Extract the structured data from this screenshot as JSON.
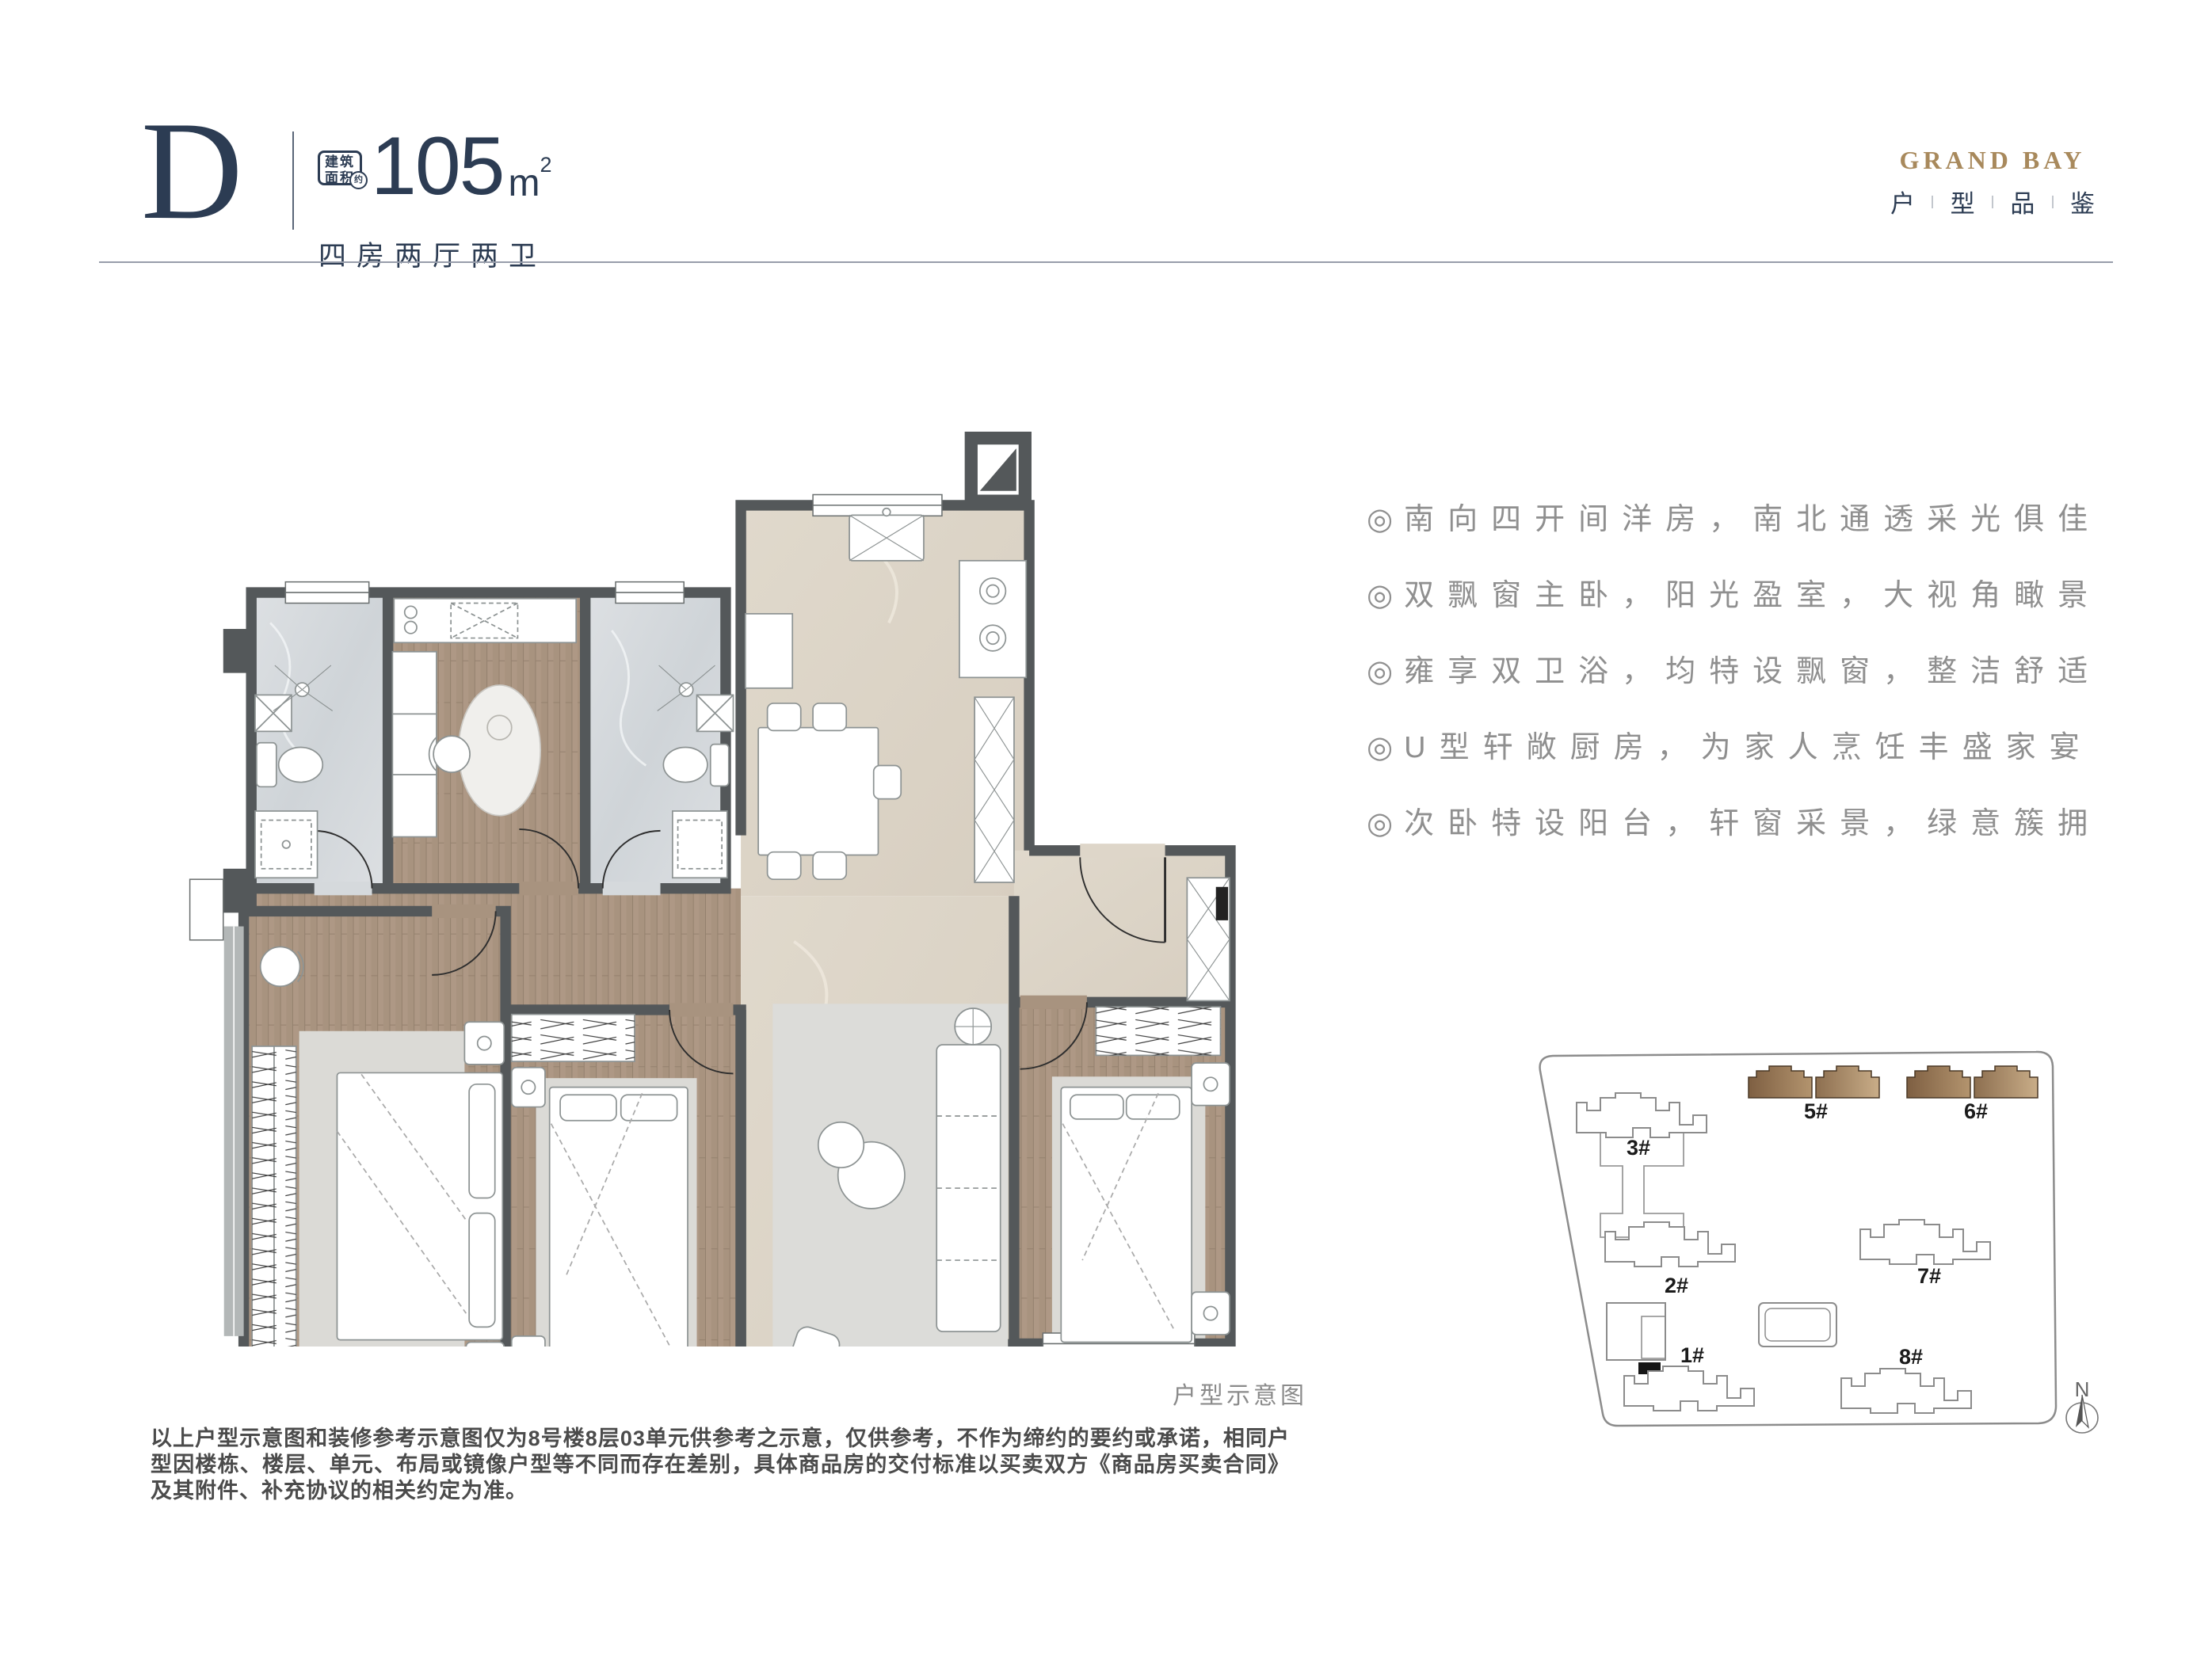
{
  "header": {
    "unit_letter": "D",
    "area_badge": {
      "line1": "建筑",
      "line2": "面积",
      "approx": "约"
    },
    "area_value": "105",
    "area_unit": "m",
    "area_sup": "2",
    "layout": "四房两厅两卫"
  },
  "brand": {
    "name": "GRAND BAY",
    "tagline": [
      "户",
      "型",
      "品",
      "鉴"
    ]
  },
  "features": [
    {
      "bullet": "◎",
      "text": "南向四开间洋房，南北通透采光俱佳"
    },
    {
      "bullet": "◎",
      "text": "双飘窗主卧，阳光盈室，大视角瞰景"
    },
    {
      "bullet": "◎",
      "text": "雍享双卫浴，均特设飘窗，整洁舒适"
    },
    {
      "bullet": "◎",
      "text": "U型轩敞厨房，为家人烹饪丰盛家宴"
    },
    {
      "bullet": "◎",
      "text": "次卧特设阳台，轩窗采景，绿意簇拥"
    }
  ],
  "floorplan": {
    "caption": "户型示意图"
  },
  "siteplan": {
    "compass": "N",
    "buildings": [
      {
        "label": "1#",
        "highlight": false
      },
      {
        "label": "2#",
        "highlight": false
      },
      {
        "label": "3#",
        "highlight": false
      },
      {
        "label": "5#",
        "highlight": true
      },
      {
        "label": "6#",
        "highlight": true
      },
      {
        "label": "7#",
        "highlight": false
      },
      {
        "label": "8#",
        "highlight": false
      }
    ]
  },
  "disclaimer": "以上户型示意图和装修参考示意图仅为8号楼8层03单元供参考之示意，仅供参考，不作为缔约的要约或承诺，相同户型因楼栋、楼层、单元、布局或镜像户型等不同而存在差别，具体商品房的交付标准以买卖双方《商品房买卖合同》及其附件、补充协议的相关约定为准。",
  "colors": {
    "navy": "#2c3c53",
    "gold": "#a8895c",
    "feature_gray": "#8f8f8f",
    "wall": "#54585a",
    "wood": "#a8937f",
    "marble": "#d9dcde",
    "tile": "#ddd5c8",
    "highlight_brown": "#8a6a4b"
  }
}
